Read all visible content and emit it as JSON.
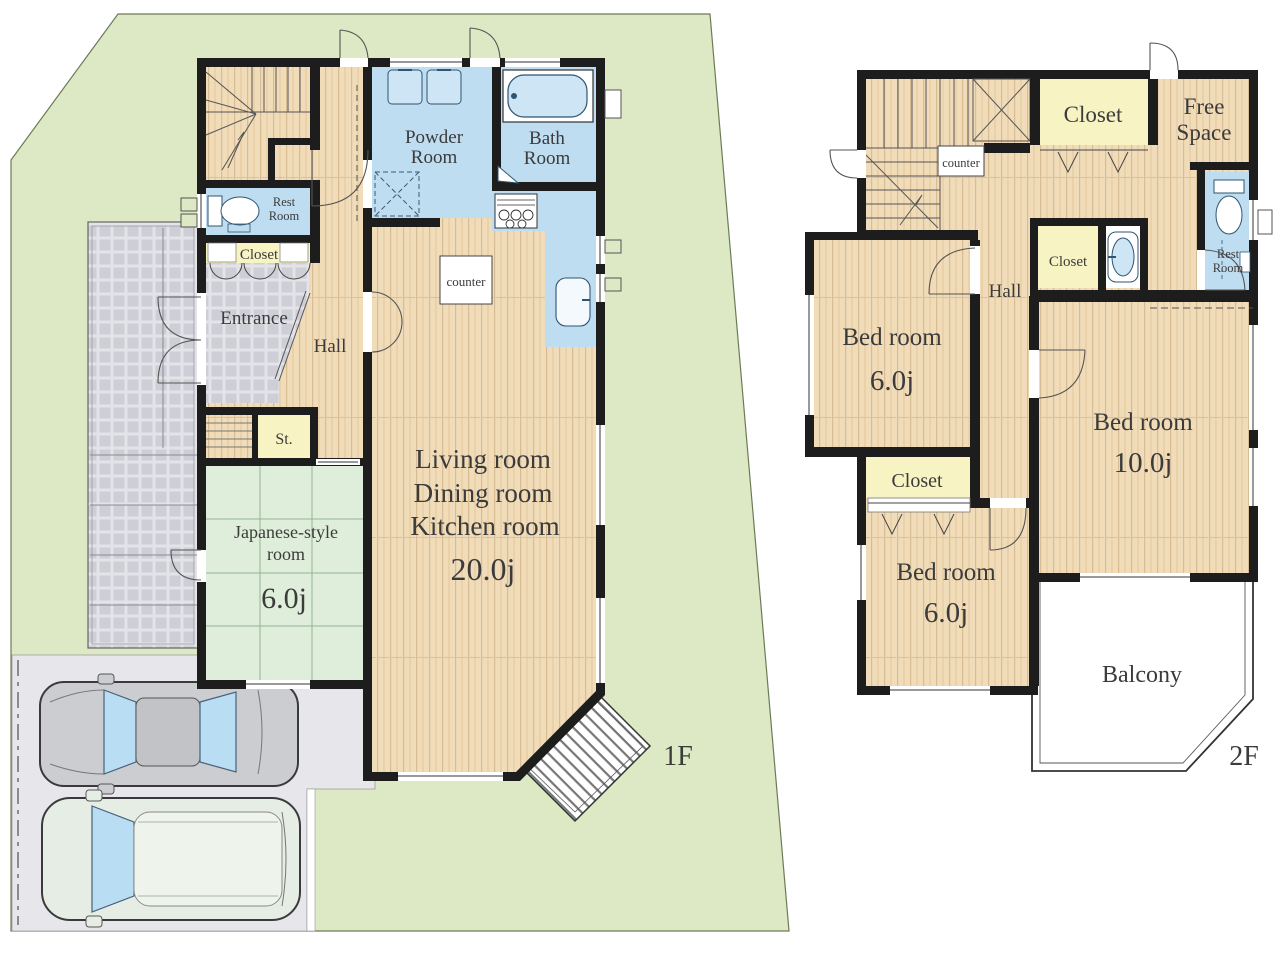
{
  "title": "House floor plan 1F / 2F",
  "colors": {
    "lot": "#dde8c4",
    "wall": "#1d1d1d",
    "wood": "#f1dcba",
    "wet_area": "#bfddf1",
    "closet": "#f7f3c3",
    "tatami": "#dfeeda",
    "paving": "#e7e7eb",
    "tile": "#cdced6",
    "fixture": "#cde5f5"
  },
  "f1": {
    "floor_label": "1F",
    "powder_room": {
      "l1": "Powder",
      "l2": "Room"
    },
    "bath_room": {
      "l1": "Bath",
      "l2": "Room"
    },
    "rest_room": {
      "l1": "Rest",
      "l2": "Room"
    },
    "closet": "Closet",
    "entrance": "Entrance",
    "hall": "Hall",
    "storage": "St.",
    "counter": "counter",
    "japanese_room": {
      "l1": "Japanese-style",
      "l2": "room",
      "size": "6.0j"
    },
    "ldk": {
      "l1": "Living room",
      "l2": "Dining room",
      "l3": "Kitchen room",
      "size": "20.0j"
    }
  },
  "f2": {
    "floor_label": "2F",
    "closet_top": "Closet",
    "free_space": {
      "l1": "Free",
      "l2": "Space"
    },
    "counter": "counter",
    "hall": "Hall",
    "closet_hall": "Closet",
    "rest_room": {
      "l1": "Rest",
      "l2": "Room"
    },
    "bedroom_left": {
      "name": "Bed room",
      "size": "6.0j"
    },
    "closet_left": "Closet",
    "bedroom_bottom": {
      "name": "Bed room",
      "size": "6.0j"
    },
    "bedroom_right": {
      "name": "Bed room",
      "size": "10.0j"
    },
    "balcony": "Balcony"
  }
}
